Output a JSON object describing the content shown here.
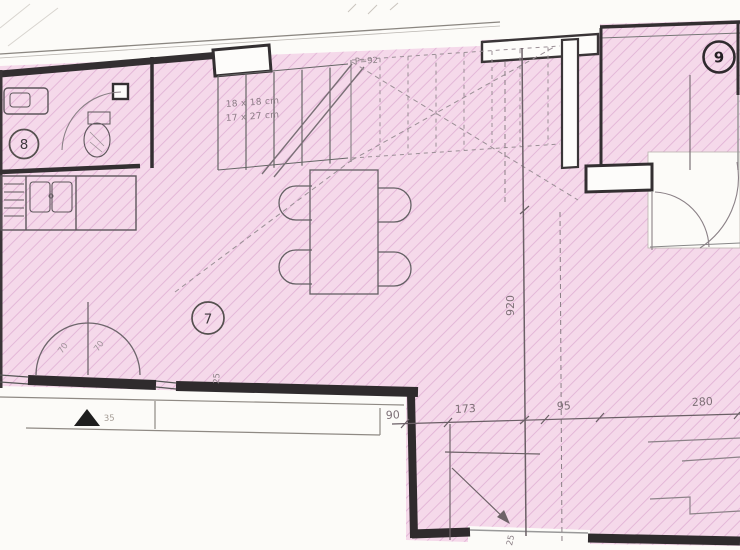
{
  "plan": {
    "rooms": [
      {
        "number": "7"
      },
      {
        "number": "8"
      },
      {
        "number": "9"
      }
    ],
    "stairs": {
      "tread_note": "18 x 18 cm",
      "riser_note": "17 x 27 cm",
      "parapet": "P=92"
    },
    "dimensions": {
      "room_depth": "920",
      "bottom_row": [
        "90",
        "173",
        "95",
        "280"
      ],
      "wall_post": "25",
      "bottom_opening": "25",
      "door_left": "70",
      "door_right": "70",
      "threshold": "35"
    },
    "colors": {
      "floor_fill": "#f5d9ea",
      "floor_hatch": "#e2b4d6",
      "wall": "#332f31",
      "background": "#fcfbf8"
    }
  }
}
